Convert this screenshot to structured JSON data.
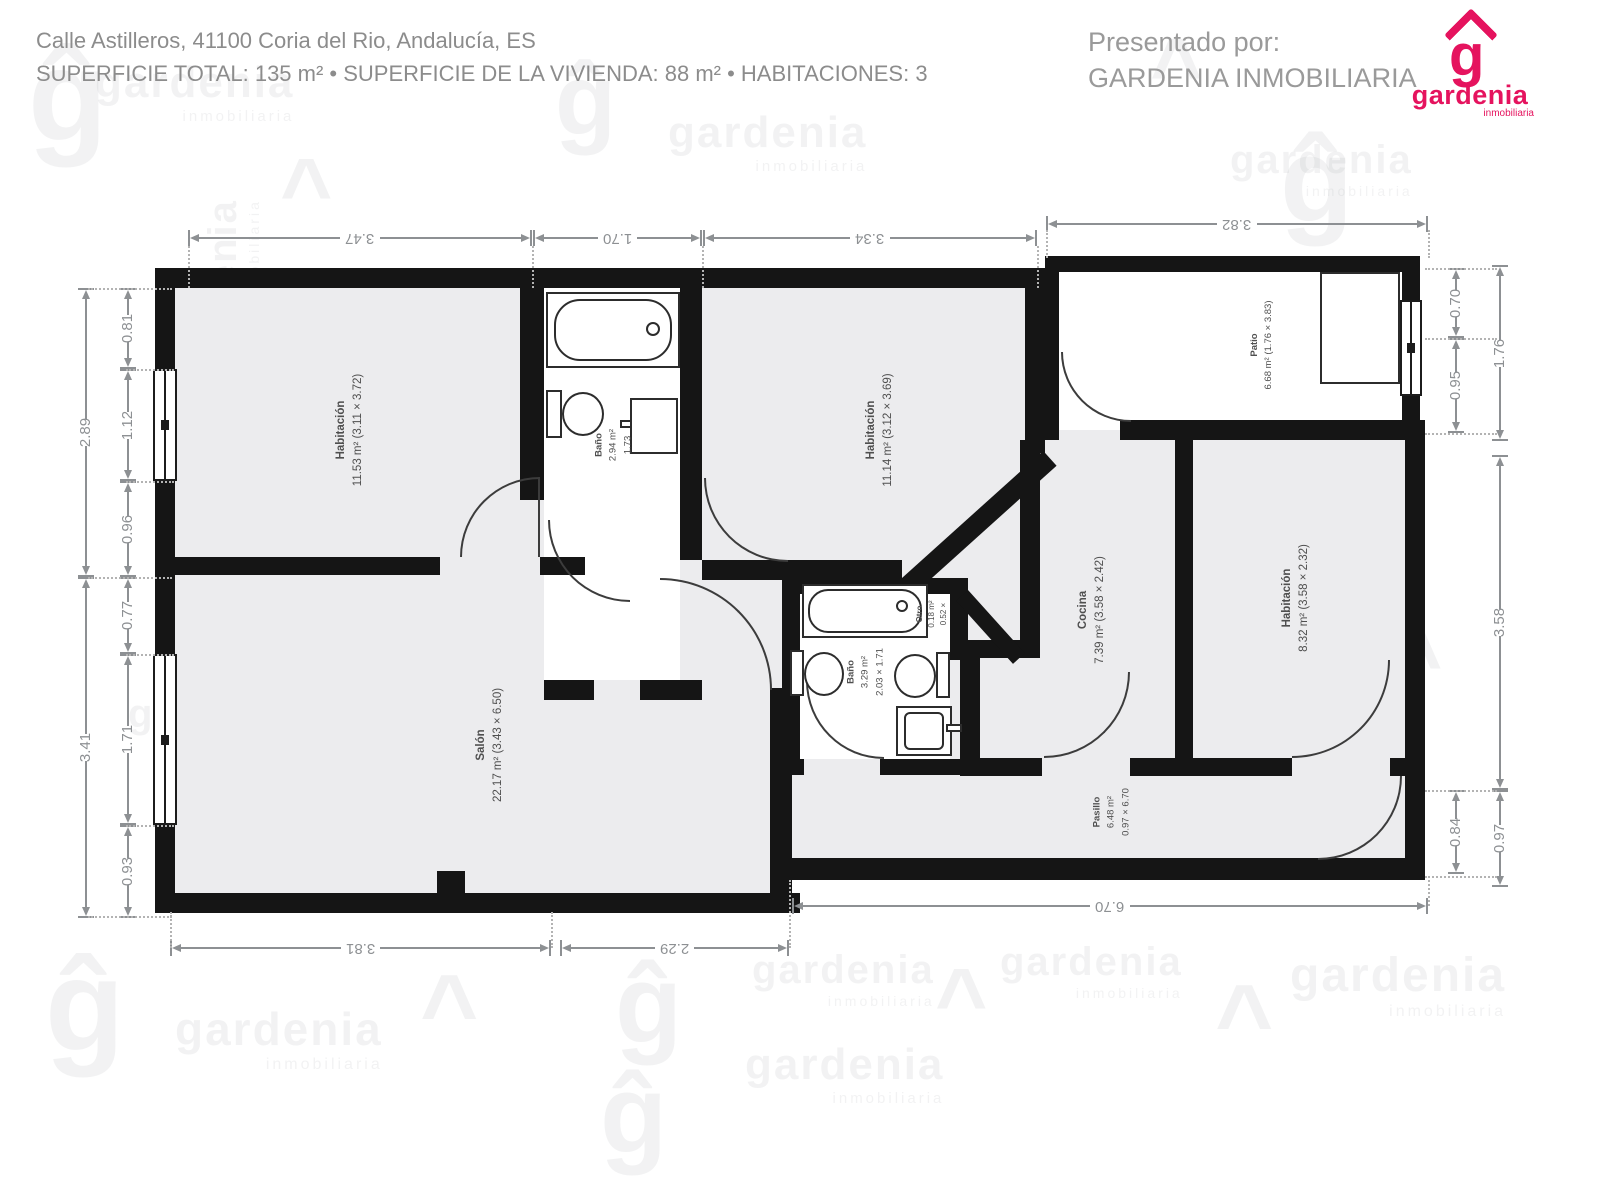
{
  "header": {
    "address": "Calle Astilleros, 41100 Coria del Rio, Andalucía, ES",
    "summary": "SUPERFICIE TOTAL: 135 m² • SUPERFICIE DE LA VIVIENDA: 88 m² • HABITACIONES: 3",
    "presented_by": "Presentado por:",
    "agency": "GARDENIA INMOBILIARIA"
  },
  "brand": {
    "name": "gardenia",
    "tagline": "inmobiliaria",
    "glyph": "g",
    "color": "#e5135e"
  },
  "watermark": {
    "word": "gardenia",
    "sub": "inmobiliaria",
    "glyph": "ĝ",
    "roof": "^",
    "items": [
      {
        "t": "glyph",
        "x": 28,
        "y": 30,
        "s": 130
      },
      {
        "t": "word",
        "x": 95,
        "y": 58,
        "s": 44
      },
      {
        "t": "glyph",
        "x": 555,
        "y": 50,
        "s": 100
      },
      {
        "t": "word",
        "x": 668,
        "y": 108,
        "s": 44
      },
      {
        "t": "roof",
        "x": 1150,
        "y": 40,
        "s": 90
      },
      {
        "t": "word",
        "x": 1230,
        "y": 138,
        "s": 40
      },
      {
        "t": "glyph",
        "x": 1280,
        "y": 120,
        "s": 120
      },
      {
        "t": "roof",
        "x": 280,
        "y": 160,
        "s": 90
      },
      {
        "t": "word",
        "x": 140,
        "y": 260,
        "s": 40,
        "r": -90
      },
      {
        "t": "glyph",
        "x": 330,
        "y": 430,
        "s": 120,
        "r": -90
      },
      {
        "t": "word",
        "x": 420,
        "y": 700,
        "s": 46,
        "r": -90
      },
      {
        "t": "word",
        "x": 600,
        "y": 770,
        "s": 40,
        "r": -90
      },
      {
        "t": "glyph",
        "x": 648,
        "y": 548,
        "s": 64
      },
      {
        "t": "word",
        "x": 720,
        "y": 560,
        "s": 48
      },
      {
        "t": "word",
        "x": 990,
        "y": 588,
        "s": 40
      },
      {
        "t": "roof",
        "x": 250,
        "y": 660,
        "s": 110
      },
      {
        "t": "word",
        "x": 128,
        "y": 692,
        "s": 40
      },
      {
        "t": "word",
        "x": 1160,
        "y": 688,
        "s": 44
      },
      {
        "t": "roof",
        "x": 1390,
        "y": 630,
        "s": 90
      },
      {
        "t": "glyph",
        "x": 45,
        "y": 940,
        "s": 130
      },
      {
        "t": "word",
        "x": 175,
        "y": 1002,
        "s": 46
      },
      {
        "t": "roof",
        "x": 420,
        "y": 975,
        "s": 100
      },
      {
        "t": "glyph",
        "x": 615,
        "y": 950,
        "s": 110
      },
      {
        "t": "word",
        "x": 752,
        "y": 948,
        "s": 40
      },
      {
        "t": "roof",
        "x": 935,
        "y": 970,
        "s": 90
      },
      {
        "t": "word",
        "x": 1000,
        "y": 940,
        "s": 40
      },
      {
        "t": "roof",
        "x": 1215,
        "y": 985,
        "s": 100
      },
      {
        "t": "word",
        "x": 1290,
        "y": 948,
        "s": 48
      },
      {
        "t": "word",
        "x": 745,
        "y": 1040,
        "s": 44
      },
      {
        "t": "glyph",
        "x": 600,
        "y": 1060,
        "s": 110
      }
    ]
  },
  "floorplan": {
    "rooms": [
      {
        "name": "Habitación",
        "line2": "11.53 m² (3.11 × 3.72)"
      },
      {
        "name": "Baño",
        "line2": "2.94 m²",
        "line3": "1.73"
      },
      {
        "name": "Habitación",
        "line2": "11.14 m² (3.12 × 3.69)"
      },
      {
        "name": "Patio",
        "line2": "6.68 m² (1.76 × 3.83)"
      },
      {
        "name": "Salón",
        "line2": "22.17 m² (3.43 × 6.50)"
      },
      {
        "name": "Baño",
        "line2": "3.29 m²",
        "line3": "2.03 × 1.71"
      },
      {
        "name": "Otro",
        "line2": "0.18 m²",
        "line3": "0.52 ×"
      },
      {
        "name": "Cocina",
        "line2": "7.39 m² (3.58 × 2.42)"
      },
      {
        "name": "Habitación",
        "line2": "8.32 m² (3.58 × 2.32)"
      },
      {
        "name": "Pasillo",
        "line2": "6.48 m²",
        "line3": "0.97 × 6.70"
      }
    ],
    "dims": {
      "top": [
        "3.47",
        "1.70",
        "3.34",
        "3.82"
      ],
      "left_outer": [
        "2.89",
        "3.41"
      ],
      "left_inner": [
        "0.81",
        "1.12",
        "0.96",
        "0.77",
        "1.71",
        "0.93"
      ],
      "right_inner": [
        "0.70",
        "0.95",
        "0.84"
      ],
      "right_outer": [
        "1.76",
        "3.58",
        "0.97"
      ],
      "bottom": [
        "3.81",
        "2.29",
        "6.70"
      ]
    }
  }
}
